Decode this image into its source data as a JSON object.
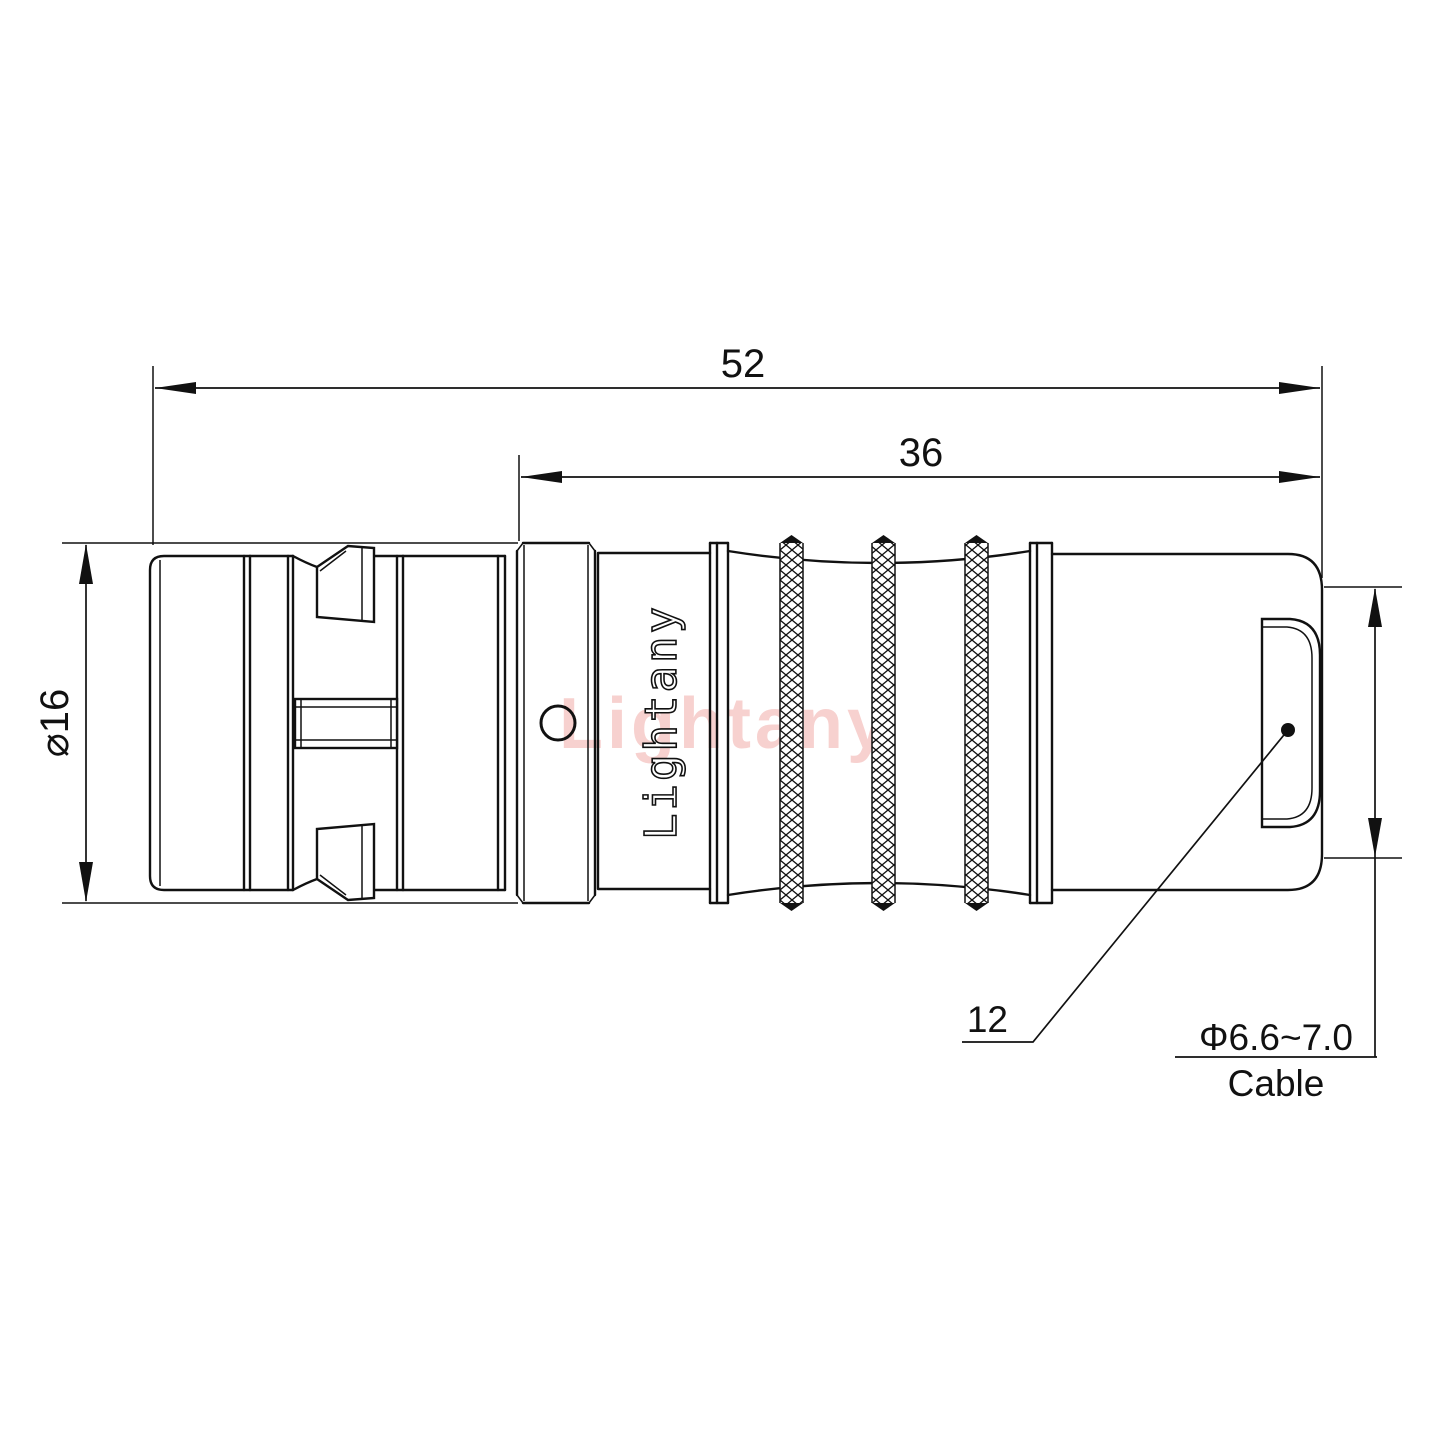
{
  "drawing": {
    "type": "technical-dimension-drawing",
    "subject": "push-pull cable connector, side view",
    "watermark_text": "Lightany",
    "engraving_text": "Lightany",
    "colors": {
      "line": "#111111",
      "background": "#ffffff",
      "watermark_pink": "#e97873"
    },
    "dimensions": {
      "overall_length": "52",
      "rear_section_length": "36",
      "body_diameter": "⌀16",
      "rear_nut_length": "12",
      "cable_spec": "Φ6.6~7.0",
      "cable_word": "Cable"
    }
  }
}
